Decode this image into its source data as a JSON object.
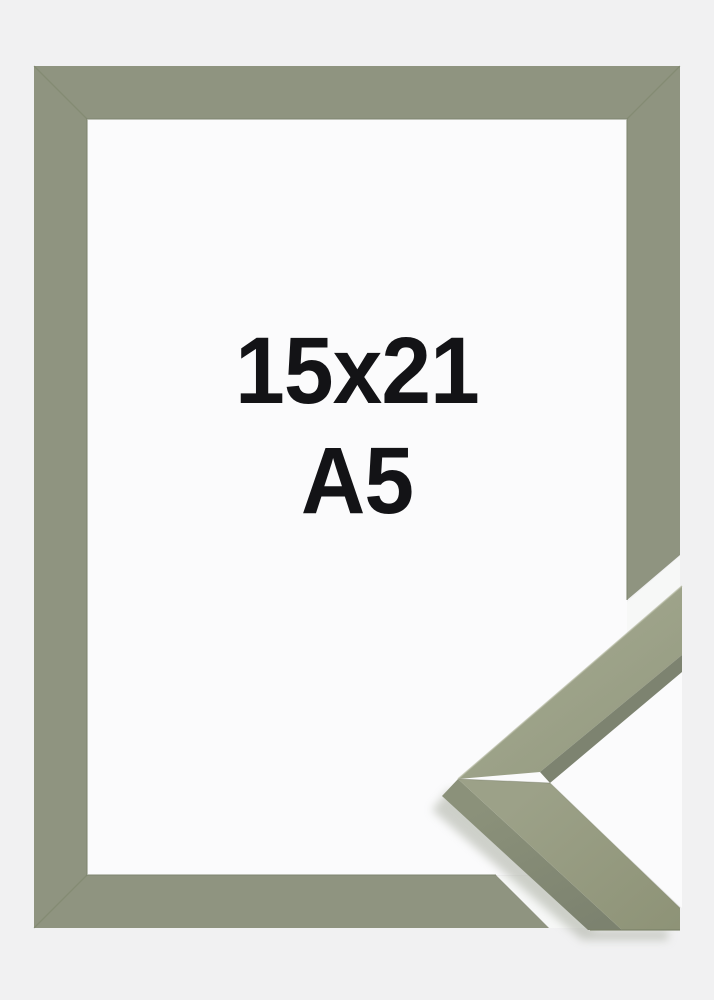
{
  "product_image": {
    "size_label": "15x21",
    "format_label": "A5"
  },
  "colors": {
    "background": "#f1f1f2",
    "interior_white": "#fbfbfc",
    "frame_green": "#8f9480",
    "label_text": "#131316"
  }
}
